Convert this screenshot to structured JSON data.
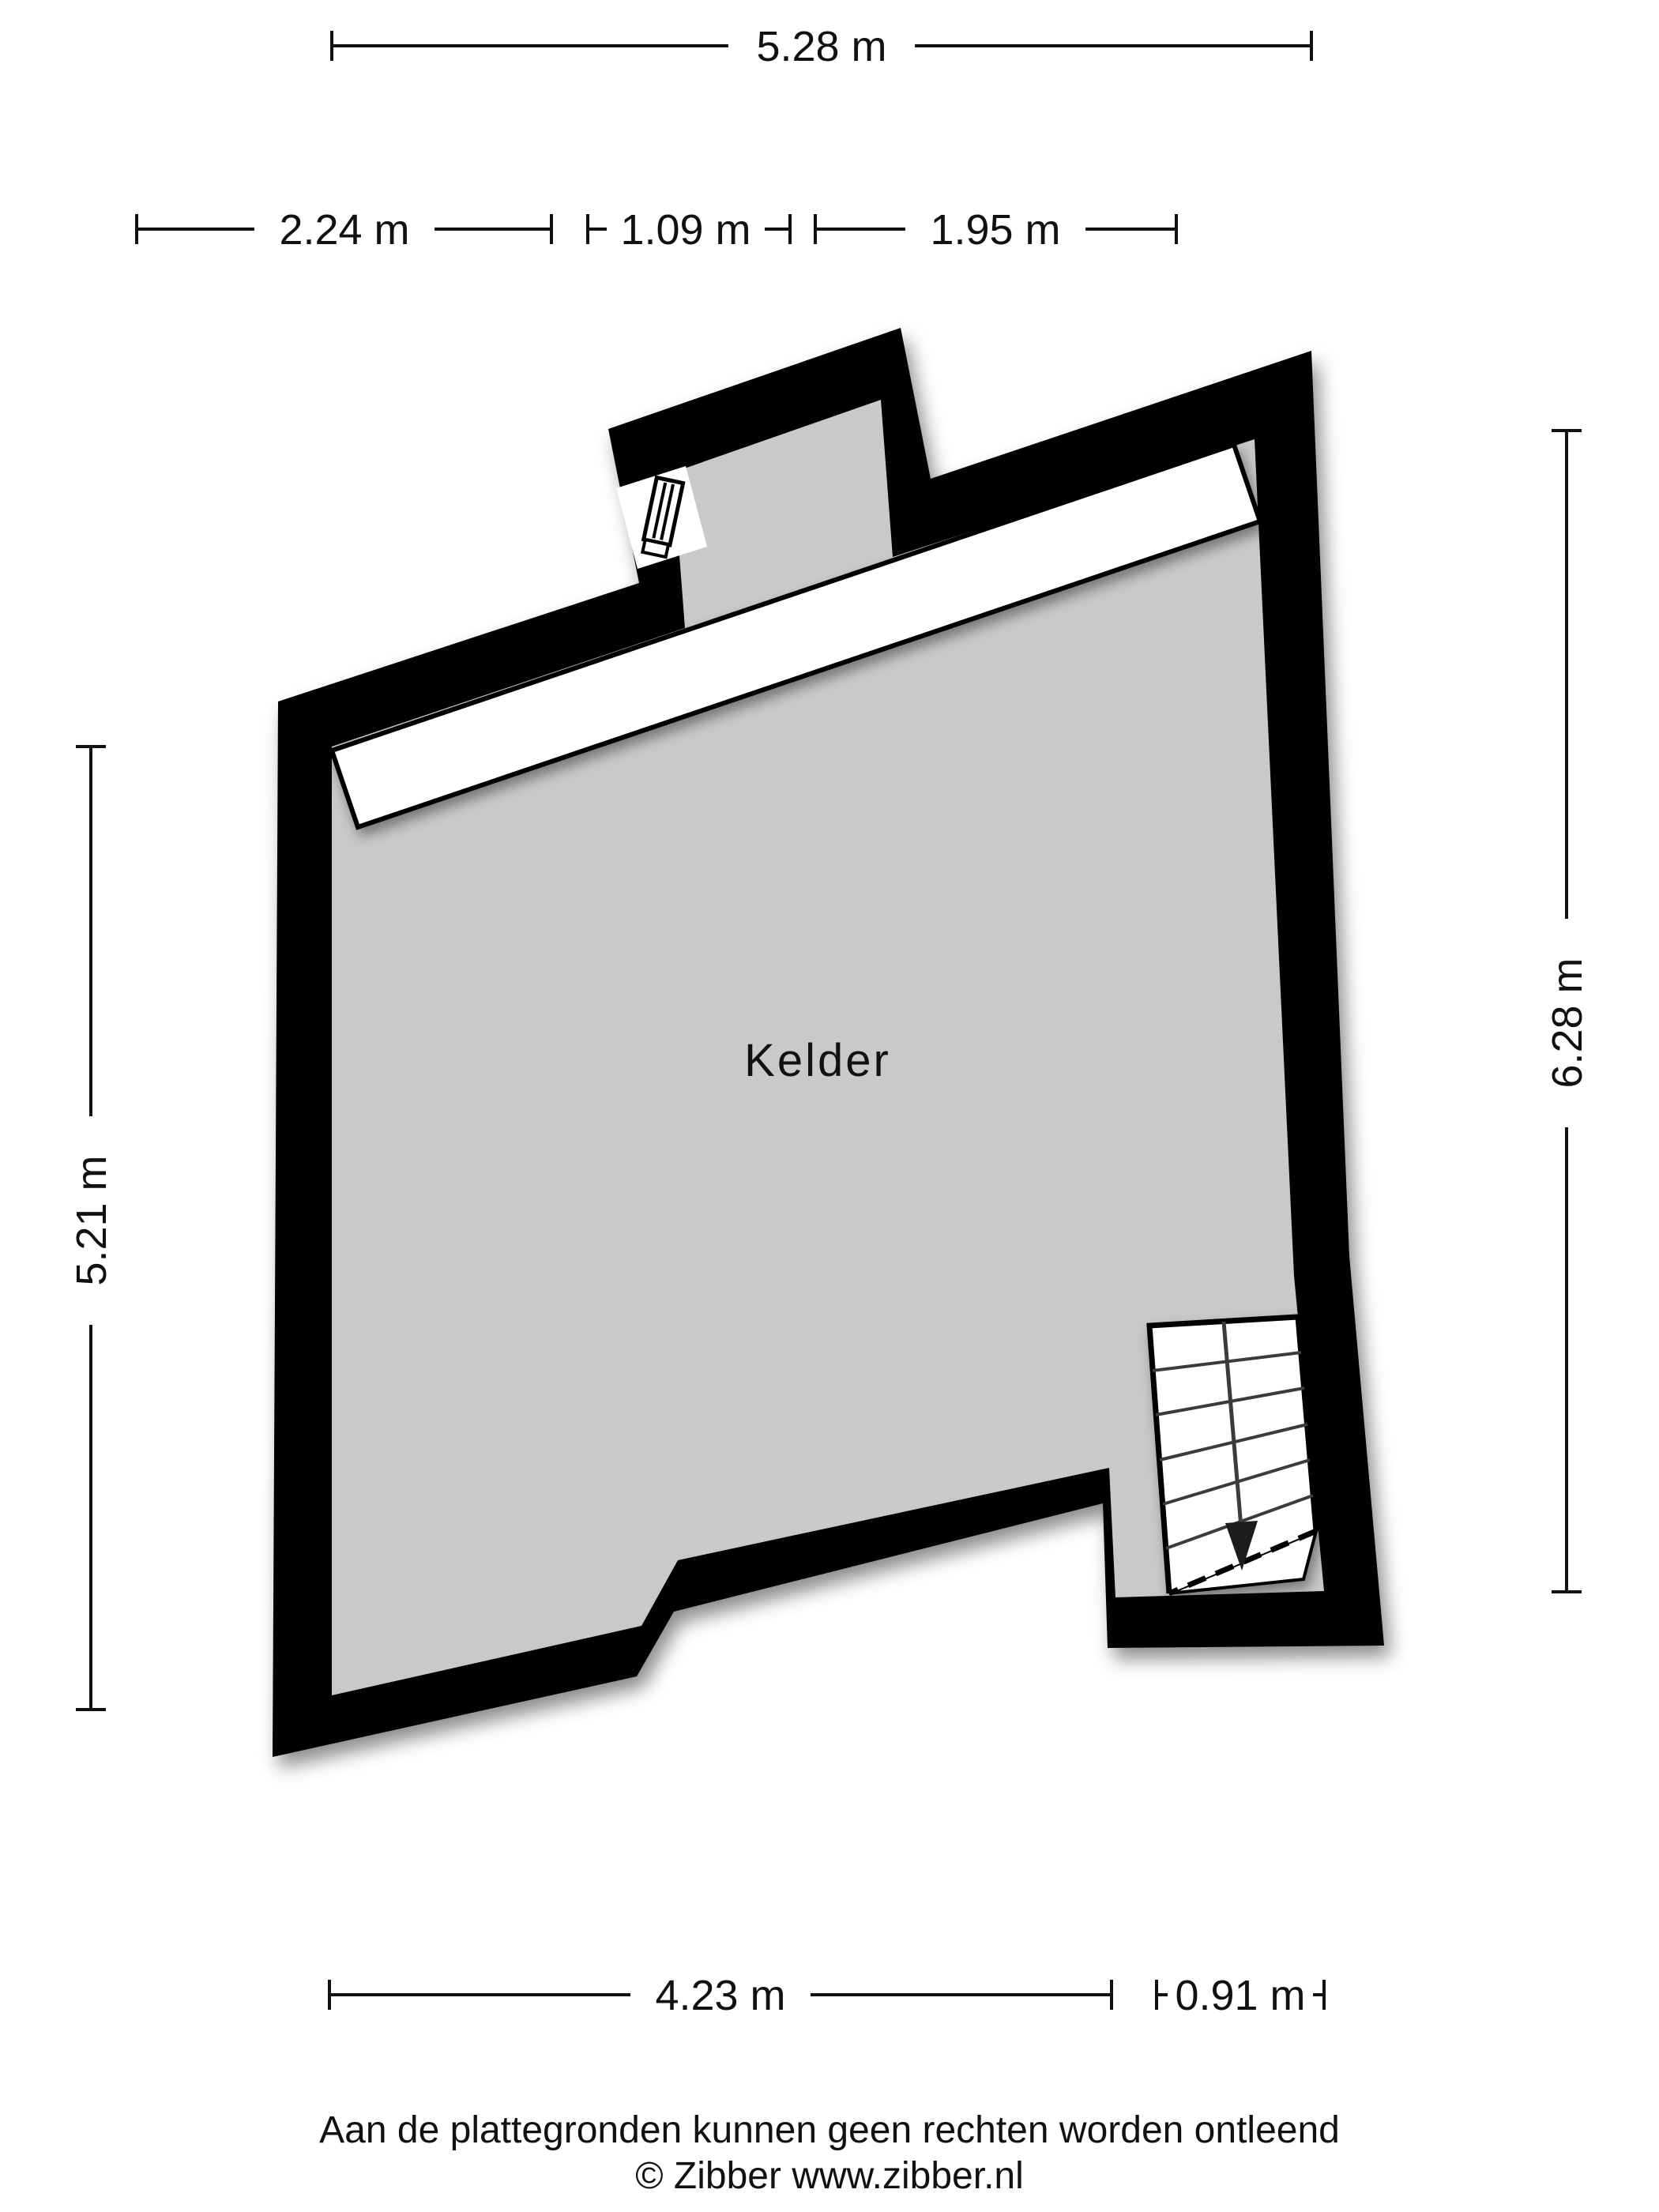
{
  "floorplan": {
    "room": {
      "label": "Kelder"
    },
    "dimensions": {
      "top": "5.28 m",
      "upper_left": "2.24 m",
      "upper_mid": "1.09 m",
      "upper_right": "1.95 m",
      "left": "5.21 m",
      "right": "6.28 m",
      "bottom_main": "4.23 m",
      "bottom_stairs": "0.91 m"
    },
    "colors": {
      "wall": "#000000",
      "floor": "#c9c9c9",
      "background": "#ffffff",
      "dimension": "#111111"
    },
    "footer": {
      "disclaimer": "Aan de plattegronden kunnen geen rechten worden ontleend",
      "credit": "© Zibber www.zibber.nl"
    }
  }
}
